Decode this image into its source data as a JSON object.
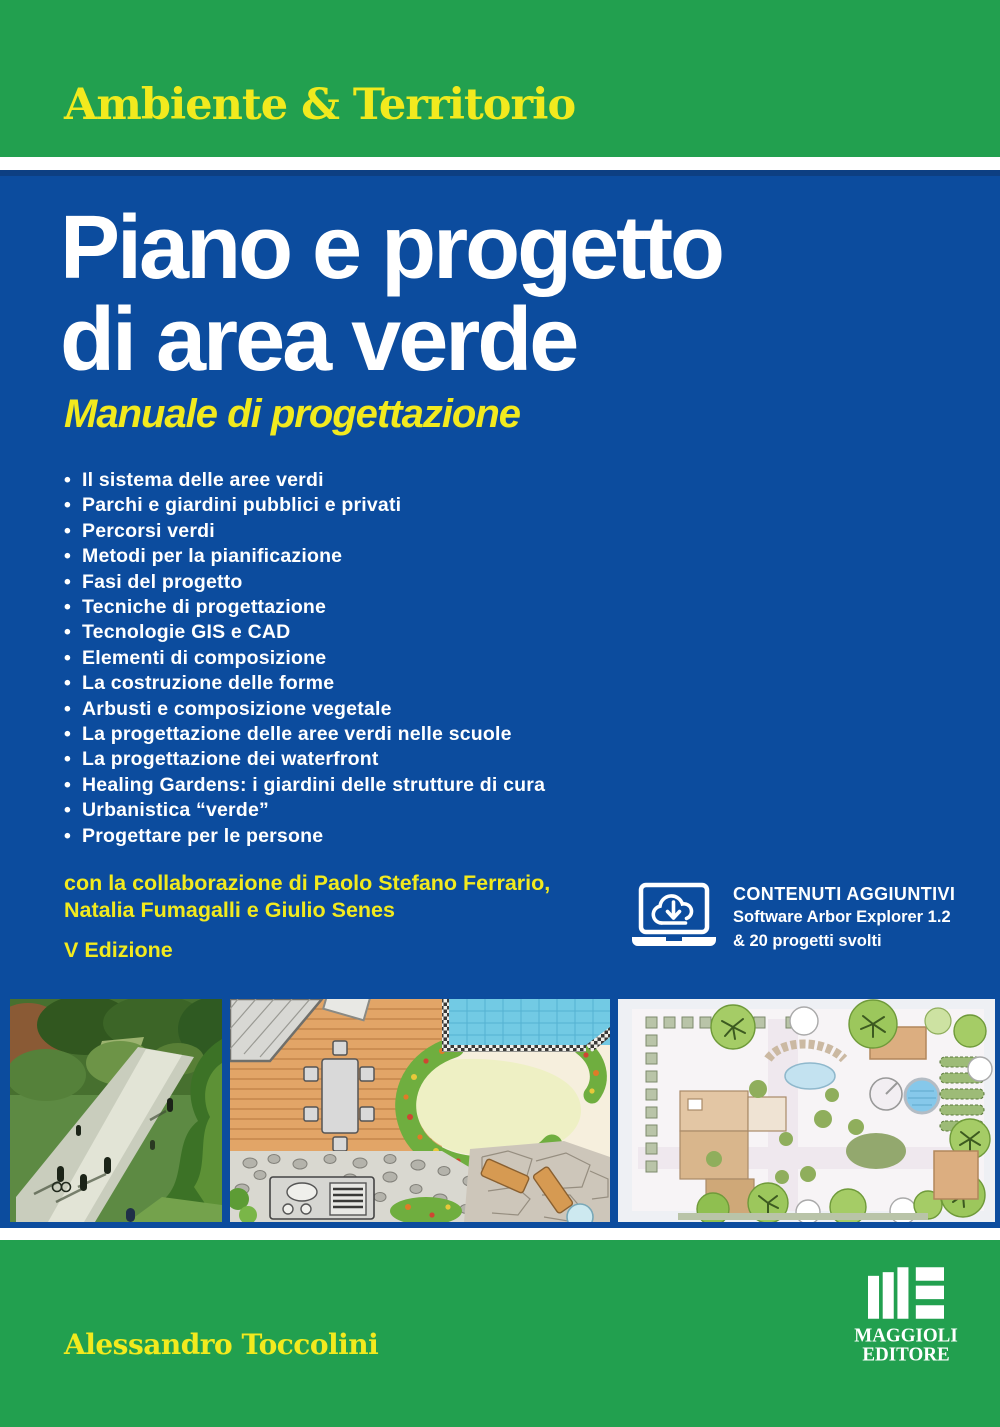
{
  "series_band": {
    "label": "Ambiente & Territorio"
  },
  "title": {
    "line1": "Piano e progetto",
    "line2": "di area verde"
  },
  "subtitle": "Manuale di progettazione",
  "bullet_char": "•",
  "topics": [
    "Il sistema delle aree verdi",
    "Parchi e giardini pubblici e privati",
    "Percorsi verdi",
    "Metodi per la pianificazione",
    "Fasi del progetto",
    "Tecniche di progettazione",
    "Tecnologie GIS e CAD",
    "Elementi di composizione",
    "La costruzione delle forme",
    "Arbusti e composizione vegetale",
    "La progettazione delle aree verdi nelle scuole",
    "La progettazione dei waterfront",
    "Healing Gardens: i giardini delle strutture di cura",
    "Urbanistica “verde”",
    "Progettare per le persone"
  ],
  "collaboration": {
    "line1": "con la collaborazione di Paolo Stefano Ferrario,",
    "line2": "Natalia Fumagalli e Giulio Senes"
  },
  "edition": "V Edizione",
  "additional_content": {
    "heading": "CONTENUTI AGGIUNTIVI",
    "line1": "Software Arbor Explorer 1.2",
    "line2": "& 20 progetti svolti",
    "icon": "laptop-cloud-download-icon"
  },
  "images": {
    "left": "greenway-path-aerial-photo",
    "middle": "hand-drawn-garden-plan",
    "right": "cad-landscape-plan"
  },
  "author": "Alessandro Toccolini",
  "publisher": {
    "line1": "MAGGIOLI",
    "line2": "EDITORE",
    "icon": "maggioli-editore-logo"
  },
  "colors": {
    "green": "#22a04f",
    "blue": "#0c4c9e",
    "yellow": "#f2ea1e",
    "white": "#ffffff"
  }
}
